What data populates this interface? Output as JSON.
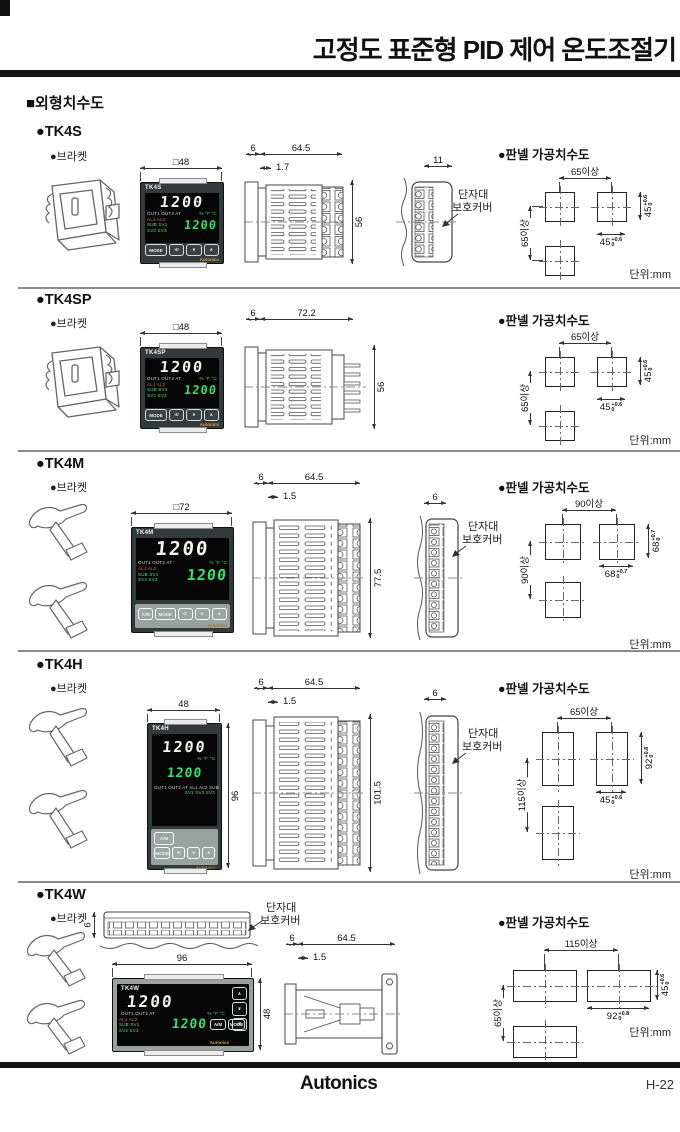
{
  "header": {
    "title": "고정도 표준형 PID 제어 온도조절기",
    "section_title": "■외형치수도"
  },
  "footer": {
    "logo": "Autonics",
    "page_no": "H-22"
  },
  "common": {
    "bracket": "●브라켓",
    "cutout_title": "●판넬 가공치수도",
    "unit": "단위:mm",
    "cover_line1": "단자대",
    "cover_line2": "보호커버"
  },
  "device": {
    "pv": "1200",
    "sv": "1200",
    "brand": "Autonics",
    "ind1": "OUT1 OUT2 AT",
    "units": "%  °F  °C",
    "al": "AL1 AL2",
    "sub": "SUB SV1",
    "sv23": "SV2 SV3",
    "h_ind1": "OUT1 OUT2 AT AL1 AL2 SUB",
    "h_ind2": "SV1 SV2 SV3",
    "btn_am": "A/M",
    "btn_mode": "MODE",
    "btn_shift": "≪",
    "btn_down": "∨",
    "btn_up": "∧"
  },
  "sections": [
    {
      "model": "●TK4S",
      "name": "TK4S",
      "front_dim": "□48",
      "d_front": "6",
      "d_body": "64.5",
      "d_bezel": "1.7",
      "d_height": "56",
      "d_cover": "11",
      "cut": {
        "h_span": "65이상",
        "v_span": "65이상",
        "right_val": "45",
        "right_tol": "+0.6",
        "bottom_val": "45",
        "bottom_tol": "+0.6",
        "tol_zero": "0"
      }
    },
    {
      "model": "●TK4SP",
      "name": "TK4SP",
      "front_dim": "□48",
      "d_front": "6",
      "d_body": "72.2",
      "d_height": "56",
      "cut": {
        "h_span": "65이상",
        "v_span": "65이상",
        "right_val": "45",
        "right_tol": "+0.6",
        "bottom_val": "45",
        "bottom_tol": "+0.6",
        "tol_zero": "0"
      }
    },
    {
      "model": "●TK4M",
      "name": "TK4M",
      "front_dim": "□72",
      "d_front": "6",
      "d_body": "64.5",
      "d_bezel": "1.5",
      "d_height": "77.5",
      "d_cover": "6",
      "cut": {
        "h_span": "90이상",
        "v_span": "90이상",
        "right_val": "68",
        "right_tol": "+0.7",
        "bottom_val": "68",
        "bottom_tol": "+0.7",
        "tol_zero": "0"
      }
    },
    {
      "model": "●TK4H",
      "name": "TK4H",
      "front_w": "48",
      "front_h": "96",
      "d_front": "6",
      "d_body": "64.5",
      "d_bezel": "1.5",
      "d_height": "101.5",
      "d_cover": "6",
      "cut": {
        "h_span": "65이상",
        "v_span": "115이상",
        "right_val": "92",
        "right_tol": "+0.8",
        "bottom_val": "45",
        "bottom_tol": "+0.6",
        "tol_zero": "0"
      }
    },
    {
      "model": "●TK4W",
      "name": "TK4W",
      "front_w": "96",
      "front_h": "48",
      "top_dim": "6",
      "d_front": "6",
      "d_body": "64.5",
      "d_bezel": "1.5",
      "cut": {
        "h_span": "115이상",
        "v_span": "65이상",
        "right_val": "45",
        "right_tol": "+0.6",
        "bottom_val": "92",
        "bottom_tol": "+0.8",
        "tol_zero": "0"
      }
    }
  ]
}
